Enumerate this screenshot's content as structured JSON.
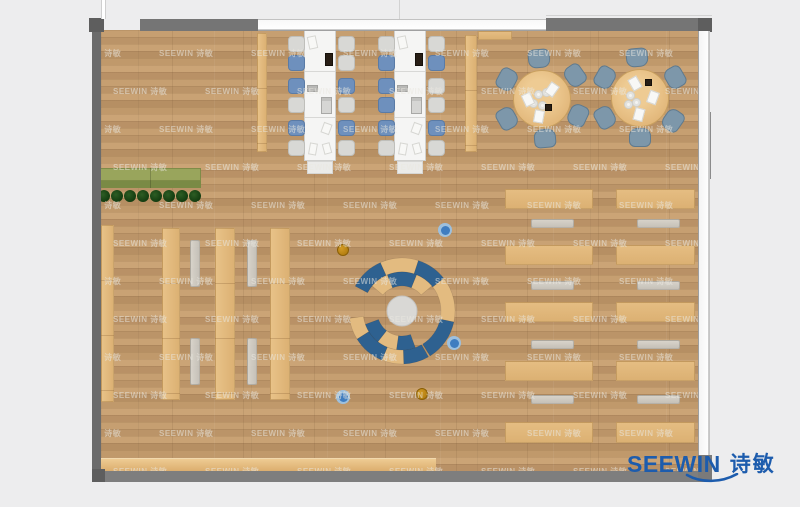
{
  "watermark": {
    "text": "SEEWIN 诗敏"
  },
  "logo": {
    "text_en": "SEEWIN",
    "text_cn": "诗敏"
  },
  "palette": {
    "outside": "#ededee",
    "wall": "#757575",
    "wall_dark": "#636363",
    "floor_base": "#c29b6d",
    "furniture_tan": "#e5bd82",
    "desk_white": "#f5f5f4",
    "chair_blue": "#6e90bd",
    "chair_gray": "#d8d8d5",
    "round_chair": "#7d97aa",
    "bench_gray": "#cfccc5",
    "planter_green": "#99a55c",
    "plant_dark": "#1d4517",
    "arc_blue": "#2e6190",
    "arc_tan": "#e3bb80",
    "center_circle": "#d9d8d5",
    "dot_blue": "#3f7dc0",
    "dot_blue_ring": "#9dc0de",
    "dot_orange": "#c18714",
    "logo_blue": "#1d5cad"
  },
  "scene": {
    "width": 800,
    "height": 507,
    "room": {
      "x": 101,
      "y": 30,
      "w": 597,
      "h": 442
    },
    "walls": [
      {
        "name": "left-wall",
        "x": 92,
        "y": 18,
        "w": 9,
        "h": 463,
        "color": "#6b6b6b"
      },
      {
        "name": "top-left-corner",
        "x": 89,
        "y": 18,
        "w": 15,
        "h": 14,
        "color": "#5e5e5e"
      },
      {
        "name": "top-wall-left",
        "x": 140,
        "y": 19,
        "w": 118,
        "h": 12,
        "color": "#757575"
      },
      {
        "name": "top-wall-right",
        "x": 546,
        "y": 18,
        "w": 166,
        "h": 13,
        "color": "#757575"
      },
      {
        "name": "bottom-wall",
        "x": 92,
        "y": 471,
        "w": 620,
        "h": 11,
        "color": "#7e7e7e"
      },
      {
        "name": "bottom-left-corner",
        "x": 92,
        "y": 469,
        "w": 13,
        "h": 13,
        "color": "#5e5e5e"
      },
      {
        "name": "top-right-corner",
        "x": 698,
        "y": 18,
        "w": 14,
        "h": 14,
        "color": "#5e5e5e"
      },
      {
        "name": "right-wall-block",
        "x": 699,
        "y": 112,
        "w": 12,
        "h": 67,
        "color": "#8b8b8b"
      },
      {
        "name": "right-wall-tick-1",
        "x": 699,
        "y": 98,
        "w": 6,
        "h": 14,
        "color": "#9a9a9a"
      },
      {
        "name": "right-wall-tick-2",
        "x": 698,
        "y": 223,
        "w": 9,
        "h": 9,
        "color": "#a8a8a8"
      },
      {
        "name": "right-wall-tick-3",
        "x": 698,
        "y": 312,
        "w": 9,
        "h": 15,
        "color": "#8f8f8f"
      },
      {
        "name": "right-wall-tick-4",
        "x": 698,
        "y": 367,
        "w": 9,
        "h": 8,
        "color": "#a8a8a8"
      },
      {
        "name": "right-wall-tick-5",
        "x": 698,
        "y": 411,
        "w": 9,
        "h": 12,
        "color": "#8f8f8f"
      },
      {
        "name": "bottom-right-corner",
        "x": 698,
        "y": 455,
        "w": 14,
        "h": 27,
        "color": "#7a7a7a"
      }
    ],
    "windows": [
      {
        "name": "top-window",
        "x": 258,
        "y": 19,
        "w": 288,
        "h": 12,
        "orient": "h"
      },
      {
        "name": "right-window",
        "x": 698,
        "y": 31,
        "w": 12,
        "h": 424,
        "orient": "v"
      }
    ],
    "outside_lines": [
      {
        "name": "door-frame-line",
        "x": 101,
        "y": 0,
        "w": 5,
        "h": 19,
        "kind": "v"
      },
      {
        "name": "grid-line-top",
        "x": 399,
        "y": 0,
        "w": 1,
        "h": 19,
        "kind": "thin"
      },
      {
        "name": "facade-line",
        "x": 546,
        "y": 15,
        "w": 166,
        "h": 1,
        "kind": "thin"
      }
    ],
    "tan_rects": [
      {
        "name": "bookshelf-1",
        "x": 101,
        "y": 225,
        "w": 13,
        "h": 177,
        "vert": true
      },
      {
        "name": "bookshelf-2",
        "x": 162,
        "y": 228,
        "w": 18,
        "h": 172,
        "vert": true
      },
      {
        "name": "bookshelf-3",
        "x": 215,
        "y": 228,
        "w": 20,
        "h": 172,
        "vert": true
      },
      {
        "name": "bookshelf-4",
        "x": 270,
        "y": 228,
        "w": 20,
        "h": 172,
        "vert": true
      },
      {
        "name": "partition-shelf-1",
        "x": 257,
        "y": 33,
        "w": 10,
        "h": 119,
        "vert": true
      },
      {
        "name": "partition-shelf-2",
        "x": 465,
        "y": 35,
        "w": 12,
        "h": 117,
        "vert": true
      },
      {
        "name": "window-shelf",
        "x": 478,
        "y": 31,
        "w": 34,
        "h": 9
      },
      {
        "name": "reading-desk",
        "x": 505,
        "y": 189,
        "w": 88,
        "h": 20
      },
      {
        "name": "reading-desk",
        "x": 505,
        "y": 245,
        "w": 88,
        "h": 20
      },
      {
        "name": "reading-desk",
        "x": 505,
        "y": 302,
        "w": 88,
        "h": 20
      },
      {
        "name": "reading-desk",
        "x": 505,
        "y": 361,
        "w": 88,
        "h": 20
      },
      {
        "name": "reading-desk",
        "x": 505,
        "y": 422,
        "w": 88,
        "h": 21
      },
      {
        "name": "reading-desk",
        "x": 616,
        "y": 189,
        "w": 79,
        "h": 20
      },
      {
        "name": "reading-desk",
        "x": 616,
        "y": 245,
        "w": 79,
        "h": 20
      },
      {
        "name": "reading-desk",
        "x": 616,
        "y": 302,
        "w": 79,
        "h": 20
      },
      {
        "name": "reading-desk",
        "x": 616,
        "y": 361,
        "w": 79,
        "h": 20
      },
      {
        "name": "reading-desk",
        "x": 616,
        "y": 422,
        "w": 79,
        "h": 21
      }
    ],
    "counter": {
      "name": "service-counter",
      "x": 100,
      "y": 458,
      "w": 336,
      "h": 14
    },
    "benches": [
      {
        "x": 190,
        "y": 240,
        "w": 10,
        "h": 47,
        "vert": true
      },
      {
        "x": 190,
        "y": 338,
        "w": 10,
        "h": 47,
        "vert": true
      },
      {
        "x": 247,
        "y": 240,
        "w": 10,
        "h": 47,
        "vert": true
      },
      {
        "x": 247,
        "y": 338,
        "w": 10,
        "h": 47,
        "vert": true
      },
      {
        "x": 531,
        "y": 219,
        "w": 43,
        "h": 9
      },
      {
        "x": 531,
        "y": 281,
        "w": 43,
        "h": 9
      },
      {
        "x": 531,
        "y": 340,
        "w": 43,
        "h": 9
      },
      {
        "x": 531,
        "y": 395,
        "w": 43,
        "h": 9
      },
      {
        "x": 637,
        "y": 219,
        "w": 43,
        "h": 9
      },
      {
        "x": 637,
        "y": 281,
        "w": 43,
        "h": 9
      },
      {
        "x": 637,
        "y": 340,
        "w": 43,
        "h": 9
      },
      {
        "x": 637,
        "y": 395,
        "w": 43,
        "h": 9
      }
    ],
    "planter": {
      "x": 100,
      "y": 168,
      "w": 101,
      "h": 20,
      "divider_x": 150
    },
    "plants": {
      "start_x": 104,
      "step": 13,
      "count": 8,
      "cy": 196,
      "r": 6
    },
    "desk_islands": [
      {
        "table": {
          "x": 304,
          "y": 30,
          "w": 32,
          "h": 131
        },
        "endcap": {
          "x": 307,
          "y": 161,
          "w": 26,
          "h": 13
        },
        "dividers": [
          71,
          117
        ],
        "chair_ys": [
          36,
          55,
          78,
          97,
          120,
          140
        ],
        "chairs_left": {
          "cx": 296,
          "colors": [
            "gray",
            "blue",
            "blue",
            "gray",
            "blue",
            "gray"
          ]
        },
        "chairs_right": {
          "cx": 346,
          "colors": [
            "gray",
            "gray",
            "blue",
            "gray",
            "blue",
            "gray"
          ]
        },
        "items": [
          {
            "x": 308,
            "y": 36,
            "w": 9,
            "h": 13,
            "c": "paper",
            "rot": -12
          },
          {
            "x": 325,
            "y": 53,
            "w": 8,
            "h": 13,
            "c": "dark",
            "rot": 0
          },
          {
            "x": 307,
            "y": 85,
            "w": 11,
            "h": 7,
            "c": "gray",
            "rot": 0
          },
          {
            "x": 321,
            "y": 97,
            "w": 11,
            "h": 17,
            "c": "laptop",
            "rot": 0
          },
          {
            "x": 322,
            "y": 123,
            "w": 9,
            "h": 11,
            "c": "paper",
            "rot": 20
          },
          {
            "x": 309,
            "y": 143,
            "w": 8,
            "h": 12,
            "c": "paper",
            "rot": 10
          },
          {
            "x": 323,
            "y": 143,
            "w": 8,
            "h": 11,
            "c": "paper",
            "rot": -15
          }
        ]
      },
      {
        "table": {
          "x": 394,
          "y": 30,
          "w": 32,
          "h": 131
        },
        "endcap": {
          "x": 397,
          "y": 161,
          "w": 26,
          "h": 13
        },
        "dividers": [
          71,
          117
        ],
        "chair_ys": [
          36,
          55,
          78,
          97,
          120,
          140
        ],
        "chairs_left": {
          "cx": 386,
          "colors": [
            "gray",
            "blue",
            "blue",
            "blue",
            "blue",
            "gray"
          ]
        },
        "chairs_right": {
          "cx": 436,
          "colors": [
            "gray",
            "blue",
            "gray",
            "gray",
            "blue",
            "gray"
          ]
        },
        "items": [
          {
            "x": 398,
            "y": 36,
            "w": 9,
            "h": 13,
            "c": "paper",
            "rot": -12
          },
          {
            "x": 415,
            "y": 53,
            "w": 8,
            "h": 13,
            "c": "dark",
            "rot": 0
          },
          {
            "x": 397,
            "y": 85,
            "w": 11,
            "h": 7,
            "c": "gray",
            "rot": 0
          },
          {
            "x": 411,
            "y": 97,
            "w": 11,
            "h": 17,
            "c": "laptop",
            "rot": 0
          },
          {
            "x": 412,
            "y": 123,
            "w": 9,
            "h": 11,
            "c": "paper",
            "rot": 20
          },
          {
            "x": 399,
            "y": 143,
            "w": 8,
            "h": 12,
            "c": "paper",
            "rot": 10
          },
          {
            "x": 413,
            "y": 143,
            "w": 8,
            "h": 11,
            "c": "paper",
            "rot": -15
          }
        ]
      }
    ],
    "round_tables": [
      {
        "cx": 542,
        "cy": 99,
        "r": 29,
        "chair_dist": 40,
        "chair_angles": [
          95,
          35,
          -25,
          -85,
          -150,
          152
        ],
        "plates": [
          [
            -4,
            -5
          ],
          [
            4,
            -7
          ],
          [
            -9,
            4
          ],
          [
            0,
            6
          ]
        ],
        "dark": [
          6,
          8
        ],
        "papers": [
          [
            10,
            -10,
            35
          ],
          [
            -14,
            0,
            -25
          ],
          [
            -3,
            17,
            10
          ]
        ]
      },
      {
        "cx": 640,
        "cy": 98,
        "r": 29,
        "chair_dist": 40,
        "chair_angles": [
          95,
          30,
          -35,
          -90,
          -150,
          150
        ],
        "plates": [
          [
            -10,
            -3
          ],
          [
            -4,
            4
          ],
          [
            -12,
            6
          ]
        ],
        "dark": [
          8,
          -16
        ],
        "papers": [
          [
            -5,
            -15,
            -30
          ],
          [
            13,
            -1,
            20
          ],
          [
            -1,
            16,
            15
          ]
        ]
      }
    ],
    "amphitheater": {
      "cx": 402,
      "cy": 311,
      "center_r": 15,
      "inner_r": [
        25,
        39
      ],
      "outer_r": [
        39,
        53
      ],
      "segments": [
        {
          "band": "outer",
          "a1": 152,
          "a2": 114,
          "color": "blue"
        },
        {
          "band": "outer",
          "a1": 114,
          "a2": 72,
          "color": "tan"
        },
        {
          "band": "outer",
          "a1": 72,
          "a2": 38,
          "color": "blue"
        },
        {
          "band": "outer",
          "a1": 38,
          "a2": -12,
          "color": "tan"
        },
        {
          "band": "outer",
          "a1": -12,
          "a2": -58,
          "color": "blue"
        },
        {
          "band": "inner",
          "a1": 140,
          "a2": 112,
          "color": "tan"
        },
        {
          "band": "inner",
          "a1": 112,
          "a2": 68,
          "color": "blue"
        },
        {
          "band": "inner",
          "a1": 68,
          "a2": 40,
          "color": "tan"
        },
        {
          "band": "outer",
          "a1": 188,
          "a2": 212,
          "color": "tan"
        },
        {
          "band": "outer",
          "a1": 212,
          "a2": 248,
          "color": "blue"
        },
        {
          "band": "outer",
          "a1": 248,
          "a2": 272,
          "color": "tan"
        },
        {
          "band": "outer",
          "a1": 272,
          "a2": 300,
          "color": "blue"
        },
        {
          "band": "inner",
          "a1": 200,
          "a2": 232,
          "color": "blue"
        },
        {
          "band": "inner",
          "a1": 232,
          "a2": 262,
          "color": "tan"
        },
        {
          "band": "inner",
          "a1": 262,
          "a2": 290,
          "color": "blue"
        }
      ]
    },
    "dots": [
      {
        "x": 445,
        "y": 230,
        "type": "blue"
      },
      {
        "x": 343,
        "y": 250,
        "type": "orange"
      },
      {
        "x": 454,
        "y": 343,
        "type": "blue"
      },
      {
        "x": 343,
        "y": 397,
        "type": "blue"
      },
      {
        "x": 422,
        "y": 394,
        "type": "orange"
      }
    ],
    "watermark_grid": {
      "x_step": 92,
      "y_step": 38,
      "row_offset": 46,
      "x_start": -34,
      "y_start": 18
    }
  }
}
